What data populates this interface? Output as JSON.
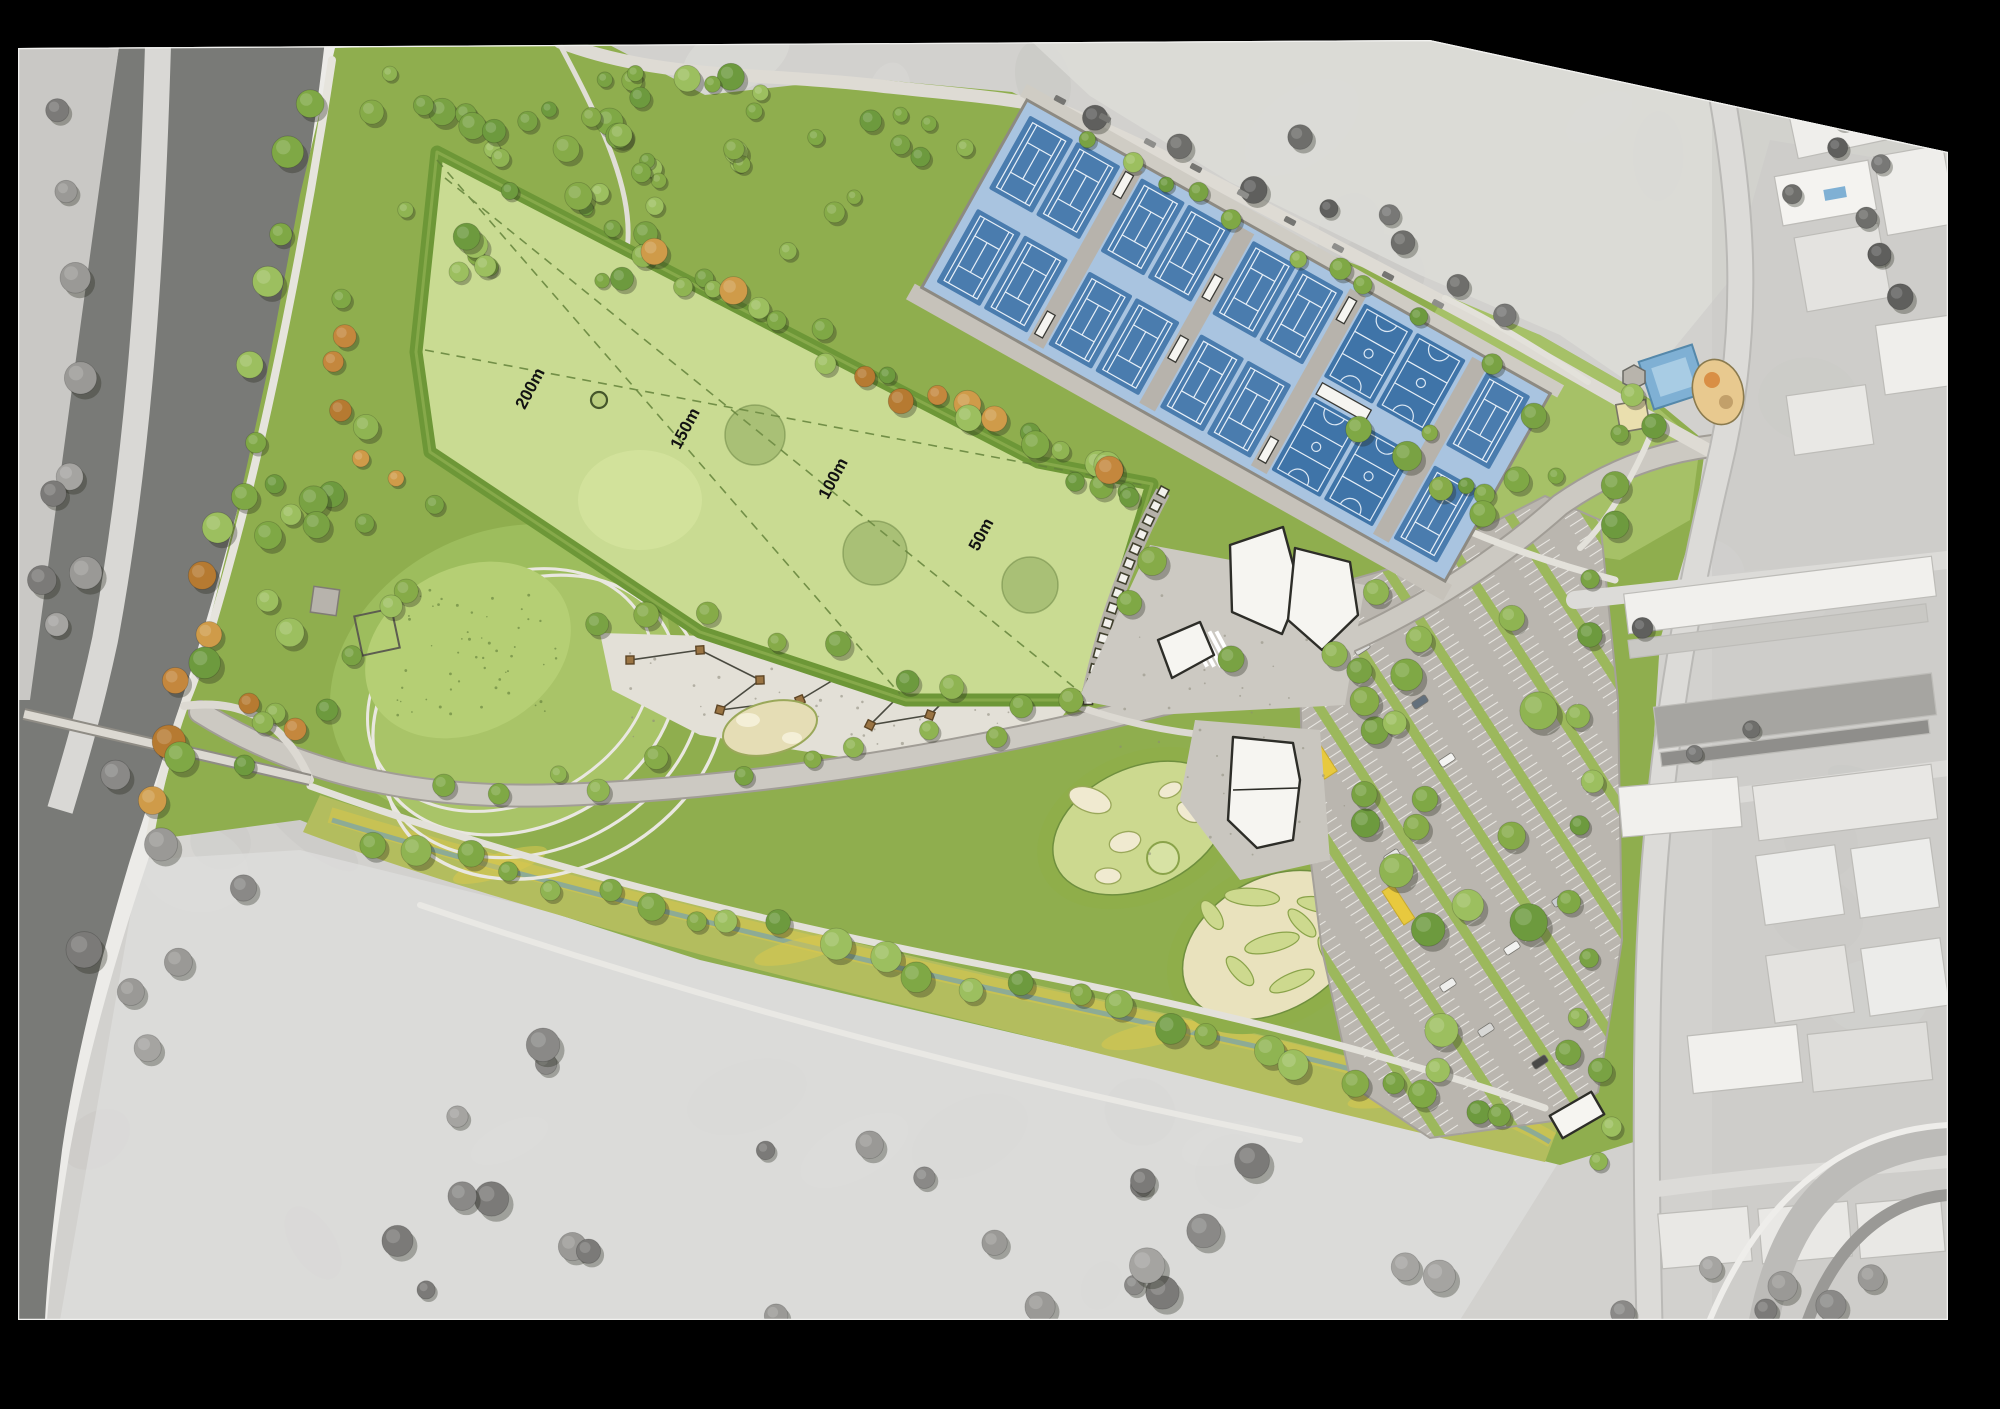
{
  "plan": {
    "type": "sports-park-masterplan-aerial-render",
    "distance_markers": {
      "d200": "200m",
      "d150": "150m",
      "d100": "100m",
      "d50": "50m"
    },
    "areas": [
      "river",
      "pedestrian-bridge",
      "riverside-promenade",
      "revegetation-woodland",
      "main-oval-field",
      "tennis-courts",
      "netball-courts",
      "court-shelters",
      "sports-pavilion",
      "community-building",
      "events-plaza",
      "terraced-seating",
      "amphitheatre-mound",
      "rope-play-playground",
      "mini-golf",
      "nature-play",
      "car-park",
      "bus-bays",
      "creek-wetland-corridor",
      "neighbourhood-playground",
      "splash-pad",
      "sand-pit",
      "residential-streets",
      "townhouses",
      "golf-course",
      "open-paddock"
    ],
    "colors": {
      "frame": "#000000",
      "aerial_gray": "#d2d1ce",
      "river": "#797a77",
      "park_green": "#8fae4e",
      "field_green": "#c9db92",
      "field_border": "#6d9737",
      "court_apron_blue": "#a9c4e0",
      "court_blue": "#4a7cae",
      "asphalt": "#b8b4ad",
      "parking_island": "#9cb85c",
      "bus_bay_yellow": "#e8c93e",
      "building_white": "#f6f5f1",
      "creek_wetland": "#b3bd5e",
      "creek_gold": "#d8c84f",
      "mini_golf": "#ccd98f",
      "plaza": "#e3e0d7"
    }
  }
}
